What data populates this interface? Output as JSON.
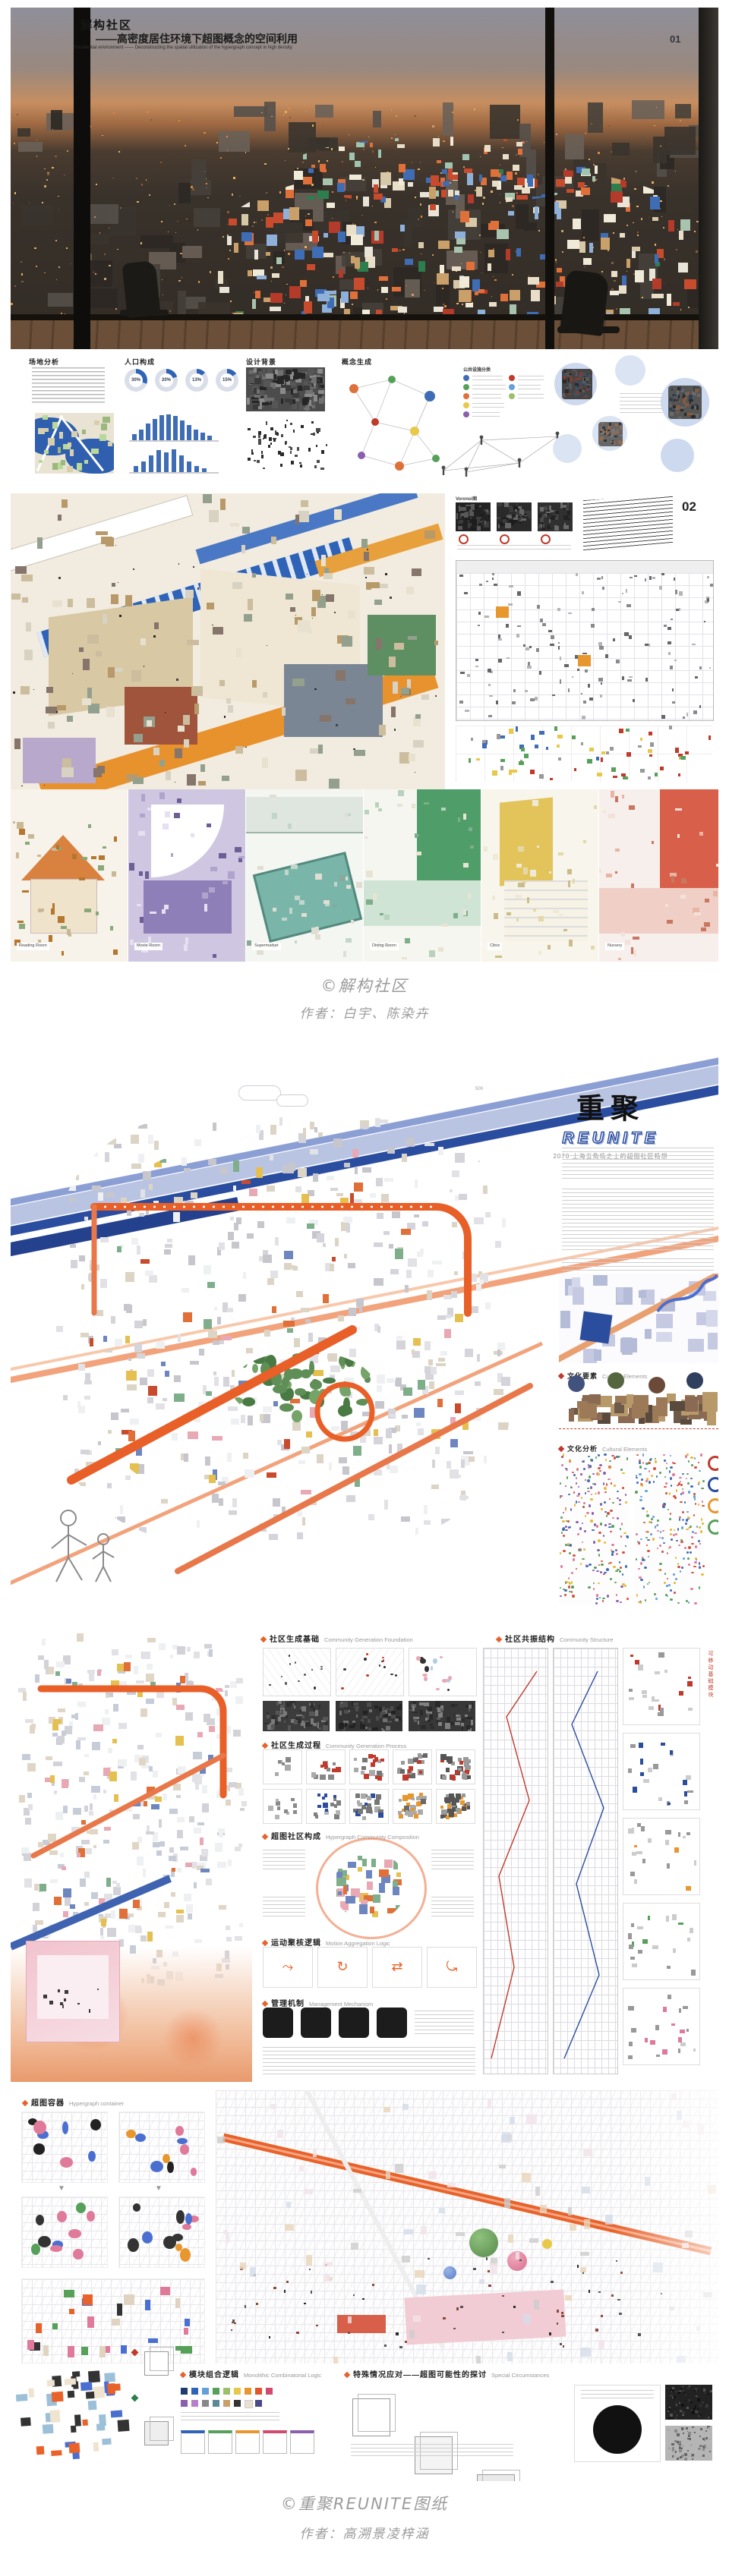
{
  "page": {
    "bg": "#ffffff"
  },
  "project1": {
    "board1": {
      "page_no": "01",
      "title": "解构社区",
      "subtitle": "——高密度居住环境下超图概念的空间利用",
      "subtitle_en": "Residential environment —— Deconstructing the spatial utilization of the hypergraph concept in high density",
      "sections": {
        "site": "场地分析",
        "population": "人口构成",
        "background": "设计背景",
        "concept": "概念生成"
      },
      "donuts": [
        "30%",
        "20%",
        "13%",
        "15%"
      ],
      "legend_title": "公共设施分类"
    },
    "board2": {
      "page_no": "02",
      "voronoi_label": "Voronoi图",
      "vignettes": [
        "Reading Room",
        "Movie Room",
        "Supermarket",
        "Dining Room",
        "Clinic",
        "Nursery"
      ]
    },
    "caption_line1": "©解构社区",
    "caption_line2": "作者：白宇、陈染卉"
  },
  "project2": {
    "board1": {
      "logo_cn": "重聚",
      "logo_en": "REUNITE",
      "logo_sub": "2070 上海五角场之上的超图社区畅想",
      "scale_note": "500",
      "section1_cn": "文化要素",
      "section1_en": "Cultural Elements",
      "section2_cn": "文化分析",
      "section2_en": "Cultural Elements"
    },
    "board2": {
      "h1_cn": "社区生成基础",
      "h1_en": "Community Generation Foundation",
      "h2_cn": "社区共振结构",
      "h2_en": "Community Structure",
      "h3_cn": "社区生成过程",
      "h3_en": "Community Generation Process",
      "h4_cn": "超图社区构成",
      "h4_en": "Hypergraph Community Composition",
      "h5_cn": "运动聚核逻辑",
      "h5_en": "Motion Aggregation Logic",
      "h6_cn": "管理机制",
      "h6_en": "Management Mechanism",
      "side_label": "可移动基础模块"
    },
    "board3": {
      "header_cn": "超图容器",
      "header_en": "Hypergraph container",
      "label1_cn": "模块组合逻辑",
      "label1_en": "Monolithic Combinatorial Logic",
      "label2_cn": "特殊情况应对——超图可能性的探讨",
      "label2_en": "Special Circumstances"
    },
    "caption_line1": "©重聚REUNITE图纸",
    "caption_line2": "作者：高溯景凌梓涵"
  },
  "colors": {
    "accent_orange": "#E8622A",
    "accent_blue": "#2B4D9E",
    "stripe_light_blue": "#8B9FD4",
    "stripe_salmon": "#F2A37C",
    "caption_gray": "#9B9B9B"
  }
}
